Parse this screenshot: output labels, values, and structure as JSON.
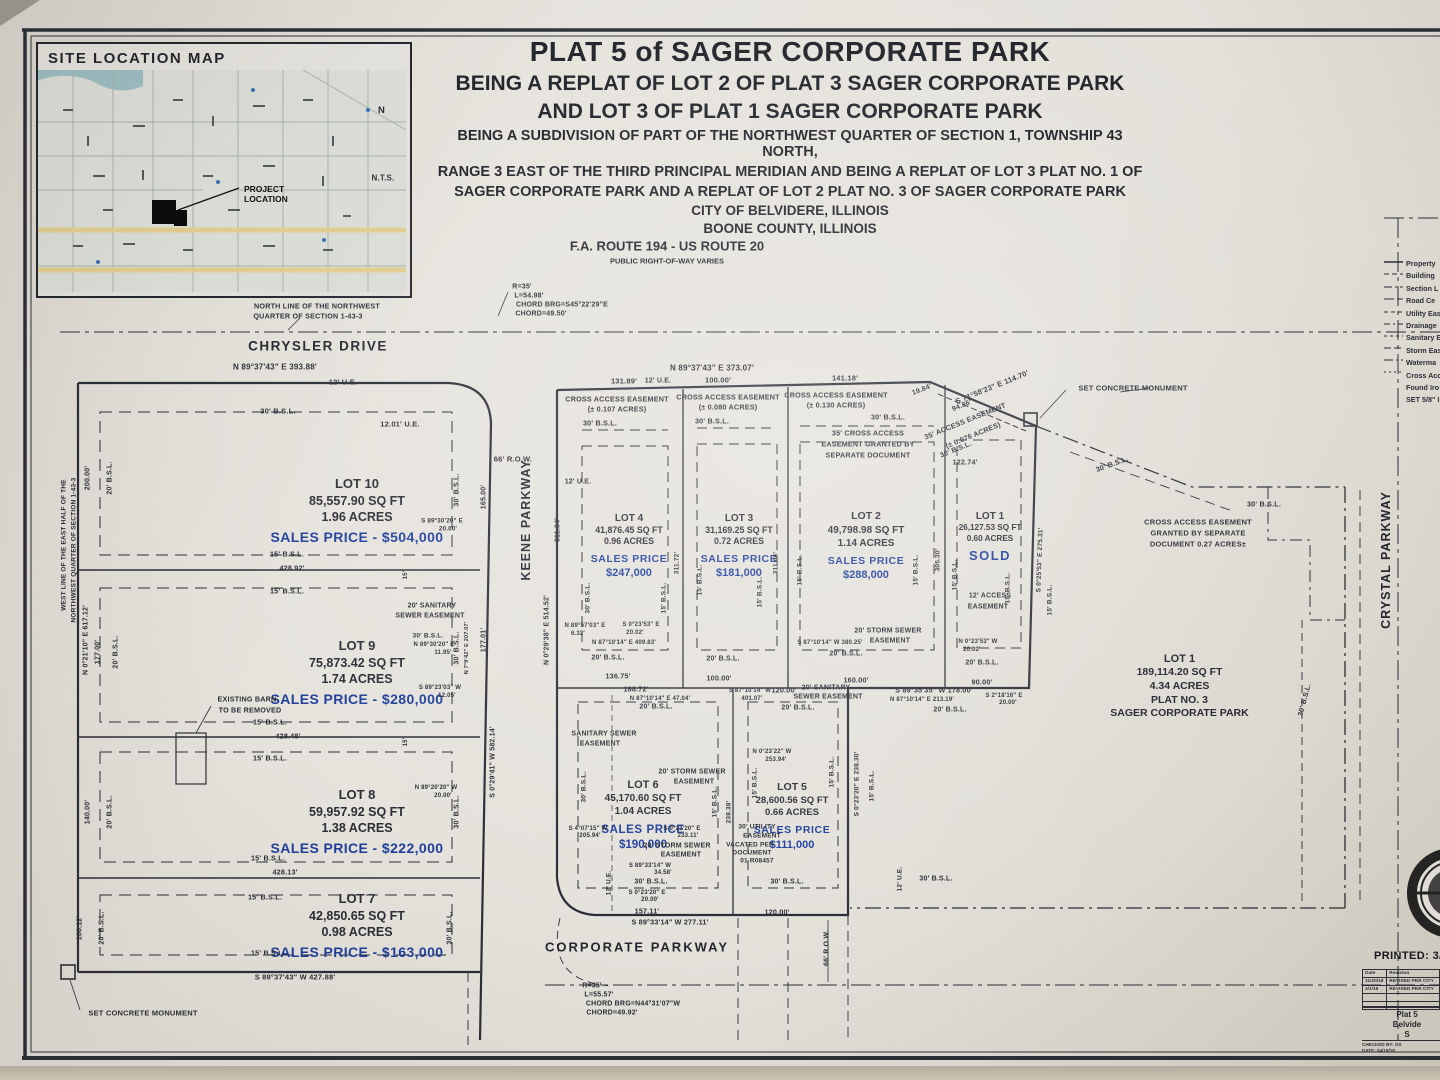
{
  "site_map": {
    "title": "SITE LOCATION MAP",
    "project_l1": "PROJECT",
    "project_l2": "LOCATION",
    "north_letter": "N",
    "nts": "N.T.S."
  },
  "title_block": {
    "l1": "PLAT 5 of SAGER CORPORATE PARK",
    "l2": "BEING A REPLAT OF LOT 2 OF PLAT 3 SAGER CORPORATE PARK",
    "l3": "AND LOT 3 OF PLAT 1 SAGER CORPORATE PARK",
    "l4": "BEING A SUBDIVISION OF PART OF THE NORTHWEST QUARTER OF SECTION 1, TOWNSHIP 43 NORTH,",
    "l5": "RANGE 3 EAST OF THE THIRD PRINCIPAL MERIDIAN AND BEING A REPLAT OF LOT 3 PLAT NO. 1 OF",
    "l6": "SAGER CORPORATE PARK AND A REPLAT OF LOT 2 PLAT NO. 3 OF SAGER CORPORATE PARK",
    "l7": "CITY OF BELVIDERE, ILLINOIS",
    "l8": "BOONE COUNTY, ILLINOIS"
  },
  "highway": {
    "name": "F.A. ROUTE 194 - US ROUTE 20",
    "sub": "PUBLIC RIGHT-OF-WAY VARIES"
  },
  "roads": {
    "chrysler": "CHRYSLER DRIVE",
    "keene": "KEENE PARKWAY",
    "corporate": "CORPORATE PARKWAY",
    "crystal": "CRYSTAL PARKWAY"
  },
  "lots": [
    {
      "name": "LOT 10",
      "area": "85,557.90 SQ FT",
      "acres": "1.96 ACRES",
      "x1": "SALES PRICE - $504,000",
      "x2": ""
    },
    {
      "name": "LOT 9",
      "area": "75,873.42 SQ FT",
      "acres": "1.74 ACRES",
      "x1": "SALES PRICE - $280,000",
      "x2": ""
    },
    {
      "name": "LOT 8",
      "area": "59,957.92 SQ FT",
      "acres": "1.38 ACRES",
      "x1": "SALES PRICE - $222,000",
      "x2": ""
    },
    {
      "name": "LOT 7",
      "area": "42,850.65 SQ FT",
      "acres": "0.98 ACRES",
      "x1": "SALES PRICE - $163,000",
      "x2": ""
    },
    {
      "name": "LOT 4",
      "area": "41,876.45 SQ FT",
      "acres": "0.96 ACRES",
      "x1": "SALES PRICE",
      "x2": "$247,000"
    },
    {
      "name": "LOT 3",
      "area": "31,169.25 SQ FT",
      "acres": "0.72 ACRES",
      "x1": "SALES PRICE",
      "x2": "$181,000"
    },
    {
      "name": "LOT 2",
      "area": "49,798.98 SQ FT",
      "acres": "1.14 ACRES",
      "x1": "SALES PRICE",
      "x2": "$288,000"
    },
    {
      "name": "LOT 1",
      "area": "26,127.53 SQ FT",
      "acres": "0.60 ACRES",
      "x1": "SOLD",
      "x2": ""
    },
    {
      "name": "LOT 6",
      "area": "45,170.60 SQ FT",
      "acres": "1.04 ACRES",
      "x1": "SALES PRICE",
      "x2": "$190,000"
    },
    {
      "name": "LOT 5",
      "area": "28,600.56 SQ FT",
      "acres": "0.66 ACRES",
      "x1": "SALES PRICE",
      "x2": "$111,000"
    },
    {
      "name": "LOT 1",
      "area": "189,114.20 SQ FT",
      "acres": "4.34 ACRES",
      "x1": "PLAT NO. 3",
      "x2": "SAGER CORPORATE PARK"
    }
  ],
  "legend": {
    "items": [
      "Property",
      "Building",
      "Section L",
      "Road Ce",
      "Utility Eas",
      "Drainage",
      "Sanitary E",
      "Storm Eas",
      "Waterma",
      "Cross Acc",
      "Found Iro",
      "SET 5/8\" I.P"
    ]
  },
  "print_block": {
    "printed": "PRINTED: 3/1/2",
    "headers": [
      "Date",
      "Revision"
    ],
    "rows": [
      [
        "11/20/18",
        "REVISED PER CITY"
      ],
      [
        "3/1/19",
        "REVISED PER CITY"
      ],
      [
        "",
        ""
      ],
      [
        "",
        ""
      ]
    ],
    "project": [
      "Plat 5",
      "Belvide",
      "S"
    ],
    "checked": "CHECKED BY: GS",
    "date": "DATE: 04/19/18"
  },
  "annotations": [
    {
      "t": "NORTH LINE OF THE NORTHWEST",
      "x": 317,
      "y": 306,
      "s": 7.2
    },
    {
      "t": "QUARTER OF SECTION 1-43-3",
      "x": 308,
      "y": 316,
      "s": 7.2
    },
    {
      "t": "R=35'",
      "x": 522,
      "y": 287,
      "s": 7
    },
    {
      "t": "L=54.98'",
      "x": 529,
      "y": 296,
      "s": 7
    },
    {
      "t": "CHORD BRG=S45°22'29\"E",
      "x": 562,
      "y": 305,
      "s": 7
    },
    {
      "t": "CHORD=49.50'",
      "x": 541,
      "y": 314,
      "s": 7
    },
    {
      "t": "N 89°37'43\" E   393.88'",
      "x": 275,
      "y": 367,
      "s": 8
    },
    {
      "t": "12' U.E.",
      "x": 343,
      "y": 382,
      "s": 7.5
    },
    {
      "t": "30' B.S.L.",
      "x": 278,
      "y": 411,
      "s": 7.5
    },
    {
      "t": "12.01' U.E.",
      "x": 400,
      "y": 424,
      "s": 7.5
    },
    {
      "t": "66' R.O.W.",
      "x": 513,
      "y": 459,
      "s": 7.5
    },
    {
      "t": "12' U.E.",
      "x": 578,
      "y": 482,
      "s": 7
    },
    {
      "t": "N 89°37'43\" E   373.07'",
      "x": 712,
      "y": 368,
      "s": 8
    },
    {
      "t": "131.89'",
      "x": 624,
      "y": 381,
      "s": 7.5
    },
    {
      "t": "12' U.E.",
      "x": 658,
      "y": 381,
      "s": 7
    },
    {
      "t": "100.00'",
      "x": 718,
      "y": 380,
      "s": 7.5
    },
    {
      "t": "141.18'",
      "x": 845,
      "y": 378,
      "s": 7.5
    },
    {
      "t": "19.84'",
      "x": 922,
      "y": 390,
      "r": -21,
      "s": 7
    },
    {
      "t": "S 71°58'23\" E   114.70'",
      "x": 992,
      "y": 387,
      "r": -22,
      "s": 7.5
    },
    {
      "t": "94.86'",
      "x": 962,
      "y": 406,
      "r": -22,
      "s": 7
    },
    {
      "t": "CROSS ACCESS EASEMENT",
      "x": 617,
      "y": 399,
      "s": 7.2
    },
    {
      "t": "(± 0.107 ACRES)",
      "x": 617,
      "y": 409,
      "s": 7.2
    },
    {
      "t": "CROSS ACCESS EASEMENT",
      "x": 728,
      "y": 397,
      "s": 7.2
    },
    {
      "t": "(± 0.080 ACRES)",
      "x": 728,
      "y": 407,
      "s": 7.2
    },
    {
      "t": "CROSS ACCESS EASEMENT",
      "x": 836,
      "y": 395,
      "s": 7.2
    },
    {
      "t": "(± 0.130 ACRES)",
      "x": 836,
      "y": 405,
      "s": 7.2
    },
    {
      "t": "30' B.S.L.",
      "x": 600,
      "y": 423,
      "s": 7.2
    },
    {
      "t": "30' B.S.L.",
      "x": 712,
      "y": 421,
      "s": 7.2
    },
    {
      "t": "30' B.S.L.",
      "x": 888,
      "y": 417,
      "s": 7.2
    },
    {
      "t": "35' CROSS ACCESS",
      "x": 868,
      "y": 433,
      "s": 7.2
    },
    {
      "t": "EASEMENT GRANTED BY",
      "x": 868,
      "y": 444,
      "s": 7.2
    },
    {
      "t": "SEPARATE DOCUMENT",
      "x": 868,
      "y": 455,
      "s": 7.2
    },
    {
      "t": "35' ACCESS EASEMENT",
      "x": 965,
      "y": 421,
      "r": -22,
      "s": 7.2
    },
    {
      "t": "(± 0.076 ACRES)",
      "x": 973,
      "y": 435,
      "r": -22,
      "s": 7.2
    },
    {
      "t": "30' B.S.L.",
      "x": 956,
      "y": 450,
      "r": -22,
      "s": 7
    },
    {
      "t": "122.74'",
      "x": 965,
      "y": 462,
      "s": 7.2
    },
    {
      "t": "SET CONCRETE MONUMENT",
      "x": 1133,
      "y": 388,
      "s": 7.5
    },
    {
      "t": "30' B.S.L.",
      "x": 1112,
      "y": 464,
      "r": -20,
      "s": 7.2
    },
    {
      "t": "30' B.S.L.",
      "x": 1264,
      "y": 504,
      "s": 7.2
    },
    {
      "t": "CROSS ACCESS EASEMENT",
      "x": 1198,
      "y": 522,
      "s": 7.5
    },
    {
      "t": "GRANTED BY SEPARATE",
      "x": 1198,
      "y": 533,
      "s": 7.5
    },
    {
      "t": "DOCUMENT 0.27 ACRES±",
      "x": 1198,
      "y": 544,
      "s": 7.5
    },
    {
      "t": "200.00'",
      "x": 88,
      "y": 478,
      "r": -90,
      "s": 7
    },
    {
      "t": "20' B.S.L.",
      "x": 110,
      "y": 478,
      "r": -90,
      "s": 7
    },
    {
      "t": "WEST LINE OF THE EAST HALF OF THE",
      "x": 64,
      "y": 545,
      "r": -90,
      "s": 6.5
    },
    {
      "t": "NORTHWEST QUARTER OF SECTION 1-43-3",
      "x": 74,
      "y": 550,
      "r": -90,
      "s": 6.5
    },
    {
      "t": "N 0°21'10\" E   617.12'",
      "x": 86,
      "y": 640,
      "r": -90,
      "s": 7
    },
    {
      "t": "177.00'",
      "x": 98,
      "y": 652,
      "r": -90,
      "s": 7
    },
    {
      "t": "20' B.S.L.",
      "x": 116,
      "y": 652,
      "r": -90,
      "s": 7
    },
    {
      "t": "140.00'",
      "x": 88,
      "y": 812,
      "r": -90,
      "s": 7
    },
    {
      "t": "20' B.S.L.",
      "x": 110,
      "y": 812,
      "r": -90,
      "s": 7
    },
    {
      "t": "100.12'",
      "x": 80,
      "y": 928,
      "r": -90,
      "s": 7
    },
    {
      "t": "20' B.S.L.",
      "x": 102,
      "y": 928,
      "r": -90,
      "s": 7
    },
    {
      "t": "30' B.S.L.",
      "x": 457,
      "y": 490,
      "r": -90,
      "s": 7
    },
    {
      "t": "165.00'",
      "x": 484,
      "y": 497,
      "r": -90,
      "s": 7
    },
    {
      "t": "30' B.S.L.",
      "x": 457,
      "y": 648,
      "r": -90,
      "s": 7
    },
    {
      "t": "30' B.S.L.",
      "x": 457,
      "y": 812,
      "r": -90,
      "s": 7
    },
    {
      "t": "30' B.S.L.",
      "x": 450,
      "y": 928,
      "r": -90,
      "s": 7
    },
    {
      "t": "177.01'",
      "x": 484,
      "y": 640,
      "r": -90,
      "s": 7
    },
    {
      "t": "N 7°9'42\" E  207.07'",
      "x": 467,
      "y": 648,
      "r": -90,
      "s": 5.5
    },
    {
      "t": "S 0°29'41\" W   582.14'",
      "x": 493,
      "y": 762,
      "r": -90,
      "s": 7
    },
    {
      "t": "N 0°29'38\" E   514.52'",
      "x": 547,
      "y": 630,
      "r": -90,
      "s": 7
    },
    {
      "t": "311.84'",
      "x": 558,
      "y": 530,
      "r": -90,
      "s": 7
    },
    {
      "t": "15'",
      "x": 406,
      "y": 575,
      "r": -90,
      "s": 6
    },
    {
      "t": "15'",
      "x": 406,
      "y": 742,
      "r": -90,
      "s": 6
    },
    {
      "t": "15' B.S.L.",
      "x": 287,
      "y": 554,
      "s": 7.2
    },
    {
      "t": "428.92'",
      "x": 292,
      "y": 568,
      "s": 7.2
    },
    {
      "t": "15' B.S.L.",
      "x": 287,
      "y": 591,
      "s": 7.2
    },
    {
      "t": "S 89°30'20\" E",
      "x": 442,
      "y": 521,
      "s": 6.2
    },
    {
      "t": "20.00'",
      "x": 448,
      "y": 529,
      "s": 6.2
    },
    {
      "t": "20' SANITARY",
      "x": 432,
      "y": 606,
      "s": 7
    },
    {
      "t": "SEWER EASEMENT",
      "x": 430,
      "y": 616,
      "s": 7
    },
    {
      "t": "30' B.S.L.",
      "x": 428,
      "y": 636,
      "s": 6.5
    },
    {
      "t": "N 89°30'20\" E",
      "x": 434,
      "y": 645,
      "s": 6
    },
    {
      "t": "11.95'",
      "x": 443,
      "y": 653,
      "s": 6
    },
    {
      "t": "15' B.S.L.",
      "x": 270,
      "y": 722,
      "s": 7.2
    },
    {
      "t": "428.48'",
      "x": 288,
      "y": 736,
      "s": 7.2
    },
    {
      "t": "15' B.S.L.",
      "x": 270,
      "y": 758,
      "s": 7.2
    },
    {
      "t": "S 89°23'03\" W",
      "x": 440,
      "y": 688,
      "s": 6
    },
    {
      "t": "12.05'",
      "x": 447,
      "y": 696,
      "s": 6
    },
    {
      "t": "EXISTING BARN",
      "x": 247,
      "y": 699,
      "s": 7.2
    },
    {
      "t": "TO BE REMOVED",
      "x": 250,
      "y": 710,
      "s": 7.2
    },
    {
      "t": "N 89°20'20\" W",
      "x": 436,
      "y": 788,
      "s": 6
    },
    {
      "t": "20.00'",
      "x": 443,
      "y": 796,
      "s": 6
    },
    {
      "t": "15' B.S.L.",
      "x": 268,
      "y": 858,
      "s": 7.2
    },
    {
      "t": "428.13'",
      "x": 285,
      "y": 872,
      "s": 7.2
    },
    {
      "t": "15' B.S.L.",
      "x": 265,
      "y": 897,
      "s": 7.2
    },
    {
      "t": "15' B.S.L.",
      "x": 268,
      "y": 953,
      "s": 7.2
    },
    {
      "t": "S 89°37'43\" W   427.88'",
      "x": 295,
      "y": 977,
      "s": 7.5
    },
    {
      "t": "SET CONCRETE MONUMENT",
      "x": 143,
      "y": 1013,
      "s": 7.5
    },
    {
      "t": "N 89°57'03\" E",
      "x": 585,
      "y": 626,
      "s": 6
    },
    {
      "t": "6.32'",
      "x": 578,
      "y": 634,
      "s": 6
    },
    {
      "t": "S 0°23'53\" E",
      "x": 641,
      "y": 625,
      "s": 6
    },
    {
      "t": "20.02'",
      "x": 635,
      "y": 633,
      "s": 6
    },
    {
      "t": "N 87°10'14\" E  409.83'",
      "x": 624,
      "y": 643,
      "s": 6
    },
    {
      "t": "20' B.S.L.",
      "x": 608,
      "y": 658,
      "s": 7
    },
    {
      "t": "20' B.S.L.",
      "x": 723,
      "y": 659,
      "s": 7
    },
    {
      "t": "136.75'",
      "x": 618,
      "y": 676,
      "s": 7.2
    },
    {
      "t": "188.72'",
      "x": 636,
      "y": 689,
      "s": 7.2
    },
    {
      "t": "N 87°10'14\" E   47.04'",
      "x": 660,
      "y": 699,
      "s": 6
    },
    {
      "t": "100.00'",
      "x": 719,
      "y": 678,
      "s": 7.2
    },
    {
      "t": "S 87°10'14\" W",
      "x": 750,
      "y": 691,
      "s": 6
    },
    {
      "t": "401.07'",
      "x": 752,
      "y": 699,
      "s": 6
    },
    {
      "t": "120.00'",
      "x": 784,
      "y": 690,
      "s": 7.2
    },
    {
      "t": "20' SANITARY",
      "x": 826,
      "y": 688,
      "s": 7
    },
    {
      "t": "SEWER EASEMENT",
      "x": 828,
      "y": 697,
      "s": 7
    },
    {
      "t": "160.00'",
      "x": 856,
      "y": 680,
      "s": 7.2
    },
    {
      "t": "S 87°10'14\" W  380.25'",
      "x": 830,
      "y": 643,
      "s": 6
    },
    {
      "t": "20' B.S.L.",
      "x": 846,
      "y": 654,
      "s": 7
    },
    {
      "t": "20' STORM SEWER",
      "x": 888,
      "y": 631,
      "s": 7
    },
    {
      "t": "EASEMENT",
      "x": 890,
      "y": 641,
      "s": 7
    },
    {
      "t": "S 89°35'35\" W   178.00'",
      "x": 934,
      "y": 690,
      "s": 7.2
    },
    {
      "t": "N 87°10'14\" E   213.19'",
      "x": 922,
      "y": 700,
      "s": 6
    },
    {
      "t": "90.00'",
      "x": 982,
      "y": 682,
      "s": 7.2
    },
    {
      "t": "20' B.S.L.",
      "x": 656,
      "y": 707,
      "s": 7
    },
    {
      "t": "20' B.S.L.",
      "x": 798,
      "y": 708,
      "s": 7
    },
    {
      "t": "20' B.S.L.",
      "x": 950,
      "y": 710,
      "s": 7
    },
    {
      "t": "12' ACCESS",
      "x": 990,
      "y": 596,
      "s": 7
    },
    {
      "t": "EASEMENT",
      "x": 988,
      "y": 607,
      "s": 7
    },
    {
      "t": "N 0°23'53\" W",
      "x": 978,
      "y": 642,
      "s": 6
    },
    {
      "t": "20.02'",
      "x": 972,
      "y": 650,
      "s": 6
    },
    {
      "t": "20' B.S.L.",
      "x": 982,
      "y": 663,
      "s": 7
    },
    {
      "t": "S 2°18'16\" E",
      "x": 1004,
      "y": 696,
      "s": 6
    },
    {
      "t": "20.00'",
      "x": 1008,
      "y": 703,
      "s": 6
    },
    {
      "t": "S 0°25'53\" E   275.31'",
      "x": 1040,
      "y": 560,
      "r": -88,
      "s": 6.5
    },
    {
      "t": "15' B.S.L.",
      "x": 1050,
      "y": 600,
      "r": -90,
      "s": 6.5
    },
    {
      "t": "305.30'",
      "x": 938,
      "y": 560,
      "r": -90,
      "s": 6.5
    },
    {
      "t": "30' B.S.L.",
      "x": 588,
      "y": 598,
      "r": -90,
      "s": 6.5
    },
    {
      "t": "15' B.S.L.",
      "x": 664,
      "y": 598,
      "r": -90,
      "s": 6.5
    },
    {
      "t": "311.72'",
      "x": 677,
      "y": 563,
      "r": -90,
      "s": 6.5
    },
    {
      "t": "15' B.S.L.",
      "x": 700,
      "y": 580,
      "r": -90,
      "s": 6.5
    },
    {
      "t": "15' B.S.L.",
      "x": 760,
      "y": 592,
      "r": -90,
      "s": 6.5
    },
    {
      "t": "311.66'",
      "x": 776,
      "y": 563,
      "r": -90,
      "s": 6.5
    },
    {
      "t": "15' B.S.L.",
      "x": 800,
      "y": 570,
      "r": -90,
      "s": 6.5
    },
    {
      "t": "15' B.S.L.",
      "x": 916,
      "y": 570,
      "r": -90,
      "s": 6.5
    },
    {
      "t": "15' B.S.L.",
      "x": 955,
      "y": 575,
      "r": -90,
      "s": 6.5
    },
    {
      "t": "15' B.S.L.",
      "x": 1008,
      "y": 588,
      "r": -90,
      "s": 6.5
    },
    {
      "t": "SANITARY SEWER",
      "x": 604,
      "y": 734,
      "s": 7
    },
    {
      "t": "EASEMENT",
      "x": 600,
      "y": 744,
      "s": 7
    },
    {
      "t": "N 0°23'22\" W",
      "x": 772,
      "y": 752,
      "s": 6
    },
    {
      "t": "253.94'",
      "x": 776,
      "y": 760,
      "s": 6
    },
    {
      "t": "20' STORM SEWER",
      "x": 692,
      "y": 772,
      "s": 7
    },
    {
      "t": "EASEMENT",
      "x": 694,
      "y": 782,
      "s": 7
    },
    {
      "t": "15' B.S.L.",
      "x": 755,
      "y": 783,
      "r": -90,
      "s": 6.5
    },
    {
      "t": "15' B.S.L.",
      "x": 832,
      "y": 772,
      "r": -90,
      "s": 6.5
    },
    {
      "t": "30' B.S.L.",
      "x": 584,
      "y": 787,
      "r": -90,
      "s": 6.5
    },
    {
      "t": "15' B.S.L.",
      "x": 715,
      "y": 802,
      "r": -90,
      "s": 6.5
    },
    {
      "t": "238.38'",
      "x": 729,
      "y": 812,
      "r": -90,
      "s": 6.5
    },
    {
      "t": "S 0°23'20\" E   238.30'",
      "x": 857,
      "y": 784,
      "r": -90,
      "s": 6.5
    },
    {
      "t": "15' B.S.L.",
      "x": 872,
      "y": 786,
      "r": -90,
      "s": 6.5
    },
    {
      "t": "S 4°07'15\" W",
      "x": 588,
      "y": 829,
      "s": 6
    },
    {
      "t": "205.94'",
      "x": 590,
      "y": 836,
      "s": 6
    },
    {
      "t": "S 0°23'20\" E",
      "x": 682,
      "y": 829,
      "s": 6
    },
    {
      "t": "233.11'",
      "x": 688,
      "y": 836,
      "s": 6
    },
    {
      "t": "30' UTILITY",
      "x": 757,
      "y": 827,
      "s": 6.5
    },
    {
      "t": "EASEMENT",
      "x": 762,
      "y": 836,
      "s": 6.5
    },
    {
      "t": "VACATED PER",
      "x": 750,
      "y": 845,
      "s": 6.5
    },
    {
      "t": "DOCUMENT",
      "x": 752,
      "y": 853,
      "s": 6.5
    },
    {
      "t": "01 R08457",
      "x": 757,
      "y": 861,
      "s": 6.5
    },
    {
      "t": "20' STORM SEWER",
      "x": 677,
      "y": 846,
      "s": 7
    },
    {
      "t": "EASEMENT",
      "x": 681,
      "y": 855,
      "s": 7
    },
    {
      "t": "S 89°33'14\" W",
      "x": 650,
      "y": 866,
      "s": 6
    },
    {
      "t": "34.58'",
      "x": 663,
      "y": 873,
      "s": 6
    },
    {
      "t": "30' B.S.L.",
      "x": 651,
      "y": 882,
      "s": 7
    },
    {
      "t": "S 0°23'20\" E",
      "x": 647,
      "y": 893,
      "s": 6
    },
    {
      "t": "20.00'",
      "x": 650,
      "y": 900,
      "s": 6
    },
    {
      "t": "30' B.S.L.",
      "x": 787,
      "y": 882,
      "s": 7
    },
    {
      "t": "12' U.E.",
      "x": 609,
      "y": 883,
      "r": -90,
      "s": 6.5
    },
    {
      "t": "157.11'",
      "x": 647,
      "y": 911,
      "s": 7.2
    },
    {
      "t": "120.00'",
      "x": 777,
      "y": 912,
      "s": 7.2
    },
    {
      "t": "S 89°33'14\" W   277.11'",
      "x": 670,
      "y": 922,
      "s": 7.2
    },
    {
      "t": "12' U.E.",
      "x": 900,
      "y": 879,
      "r": -90,
      "s": 6.5
    },
    {
      "t": "30' B.S.L.",
      "x": 936,
      "y": 879,
      "s": 7
    },
    {
      "t": "66' R.O.W.",
      "x": 827,
      "y": 948,
      "r": -90,
      "s": 7
    },
    {
      "t": "30' B.S.L.",
      "x": 1305,
      "y": 700,
      "r": -75,
      "s": 7
    },
    {
      "t": "R=35'",
      "x": 592,
      "y": 986,
      "s": 7
    },
    {
      "t": "L=55.57'",
      "x": 599,
      "y": 995,
      "s": 7
    },
    {
      "t": "CHORD BRG=N44°31'07\"W",
      "x": 633,
      "y": 1004,
      "s": 7
    },
    {
      "t": "CHORD=49.92'",
      "x": 612,
      "y": 1013,
      "s": 7
    }
  ]
}
